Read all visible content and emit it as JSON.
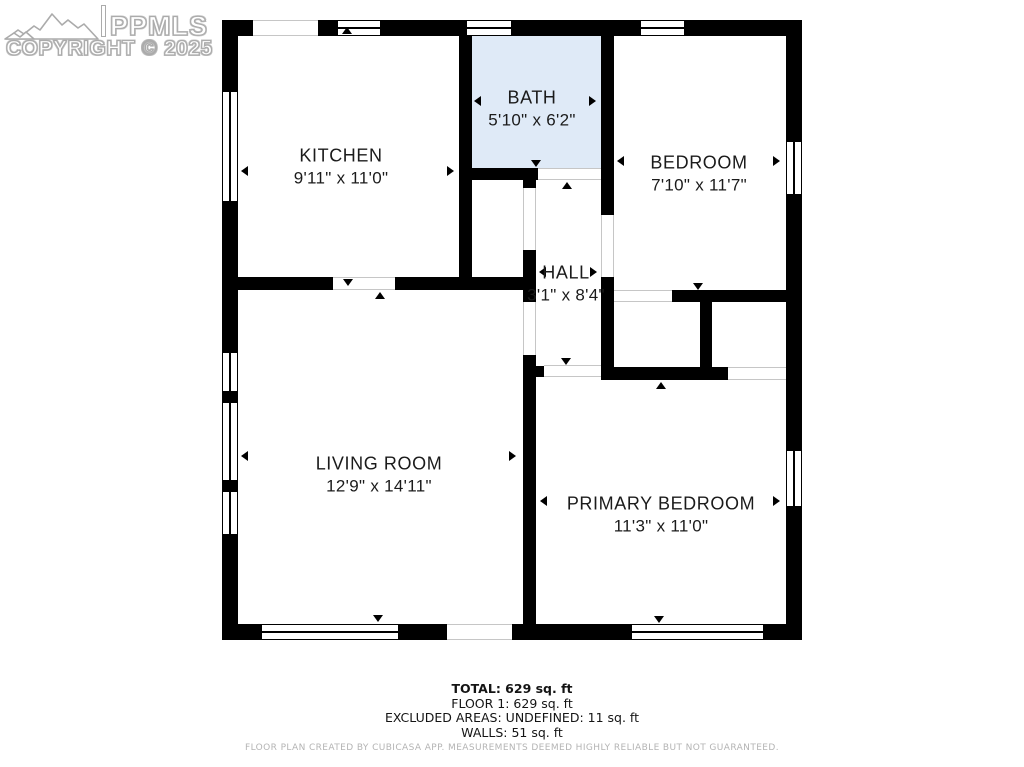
{
  "watermark": {
    "brand": "PPMLS",
    "copyright": "COPYRIGHT © 2025",
    "logo_icon": "mountain-range-icon"
  },
  "floor_plan": {
    "rooms": {
      "kitchen": {
        "name": "KITCHEN",
        "dims": "9'11\" x 11'0\""
      },
      "bath": {
        "name": "BATH",
        "dims": "5'10\" x 6'2\""
      },
      "bedroom": {
        "name": "BEDROOM",
        "dims": "7'10\" x 11'7\""
      },
      "hall": {
        "name": "HALL",
        "dims": "3'1\" x 8'4\""
      },
      "living_room": {
        "name": "LIVING ROOM",
        "dims": "12'9\" x 14'11\""
      },
      "primary_bedroom": {
        "name": "PRIMARY BEDROOM",
        "dims": "11'3\" x 11'0\""
      }
    }
  },
  "summary": {
    "total": "TOTAL: 629 sq. ft",
    "floor1": "FLOOR 1: 629 sq. ft",
    "excluded_areas": "EXCLUDED AREAS: UNDEFINED: 11 sq. ft",
    "walls": "WALLS: 51 sq. ft"
  },
  "disclaimer": "FLOOR PLAN CREATED BY CUBICASA APP. MEASUREMENTS DEEMED HIGHLY RELIABLE BUT NOT GUARANTEED.",
  "colors": {
    "wall": "#000000",
    "bath_fill": "#dfeaf7",
    "label_text": "#1b1b1b",
    "disclaimer_text": "#b4b4b4"
  }
}
